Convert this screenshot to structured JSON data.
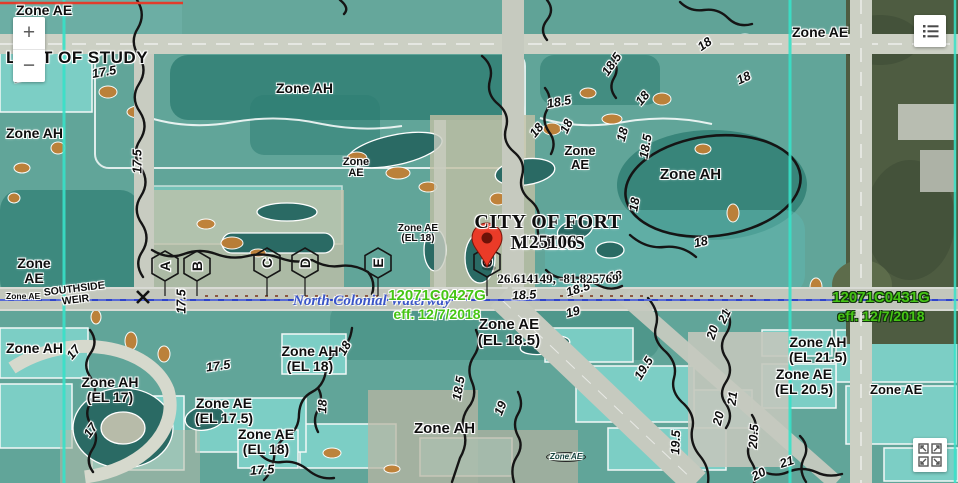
{
  "city": {
    "name": "CITY OF FORT MYERS",
    "community_id": "125106"
  },
  "coordinates": "26.614149, -81.825769",
  "panel_labels": {
    "left": {
      "id": "12071C0427G",
      "effective": "eff. 12/7/2018"
    },
    "right": {
      "id": "12071C0431G",
      "effective": "eff. 12/7/2018"
    }
  },
  "water_features": {
    "waterway": "North Colonial Waterway",
    "weir": "SOUTHSIDE WEIR"
  },
  "study_limit": "LIMIT OF STUDY",
  "zone_labels": [
    "Zone AE",
    "Zone AH",
    "Zone AH",
    "Zone AE",
    "Zone AE",
    "Zone AH",
    "Zone AH (EL 17)",
    "Zone AE (EL 17.5)",
    "Zone AE (EL 18)",
    "Zone AH (EL 18)",
    "Zone AH",
    "Zone AE (EL 18.5)",
    "Zone AE",
    "Zone AH",
    "Zone AE",
    "Zone AE",
    "Zone AE (EL 18)",
    "Zone AE",
    "Zone AH (EL 21.5)",
    "Zone AE (EL 20.5)",
    "Zone AE"
  ],
  "elevation_labels": [
    "17.5",
    "17.5",
    "17.5",
    "17.5",
    "18.5",
    "18.5",
    "18",
    "18",
    "18",
    "18",
    "18.5",
    "18",
    "18",
    "18",
    "18",
    "18.5",
    "18.5",
    "19",
    "18",
    "18.5",
    "19",
    "19.5",
    "17.5",
    "17",
    "17",
    "17.5",
    "18",
    "19.5",
    "20",
    "21",
    "21",
    "20",
    "20.5",
    "21",
    "20",
    "18"
  ],
  "cross_sections": [
    "A",
    "B",
    "C",
    "D",
    "E",
    "G"
  ],
  "controls": {
    "zoom_in": "+",
    "zoom_out": "−"
  },
  "icons": {
    "menu_icon": "legend-list",
    "expand_icon": "four-corner-arrows",
    "zoom_in_icon": "plus",
    "zoom_out_icon": "minus",
    "pin_icon": "red-location-pin"
  },
  "colors": {
    "flood_zone_teal": "#4ea69e",
    "boundary_aqua": "#38e2c8",
    "panel_label_green": "#46c515",
    "pin_red": "#ea3b28",
    "waterway_blue": "#3a55c8",
    "study_line_red": "#e23c2b",
    "orange_zone": "#c07f35",
    "contour_black": "#151515"
  }
}
